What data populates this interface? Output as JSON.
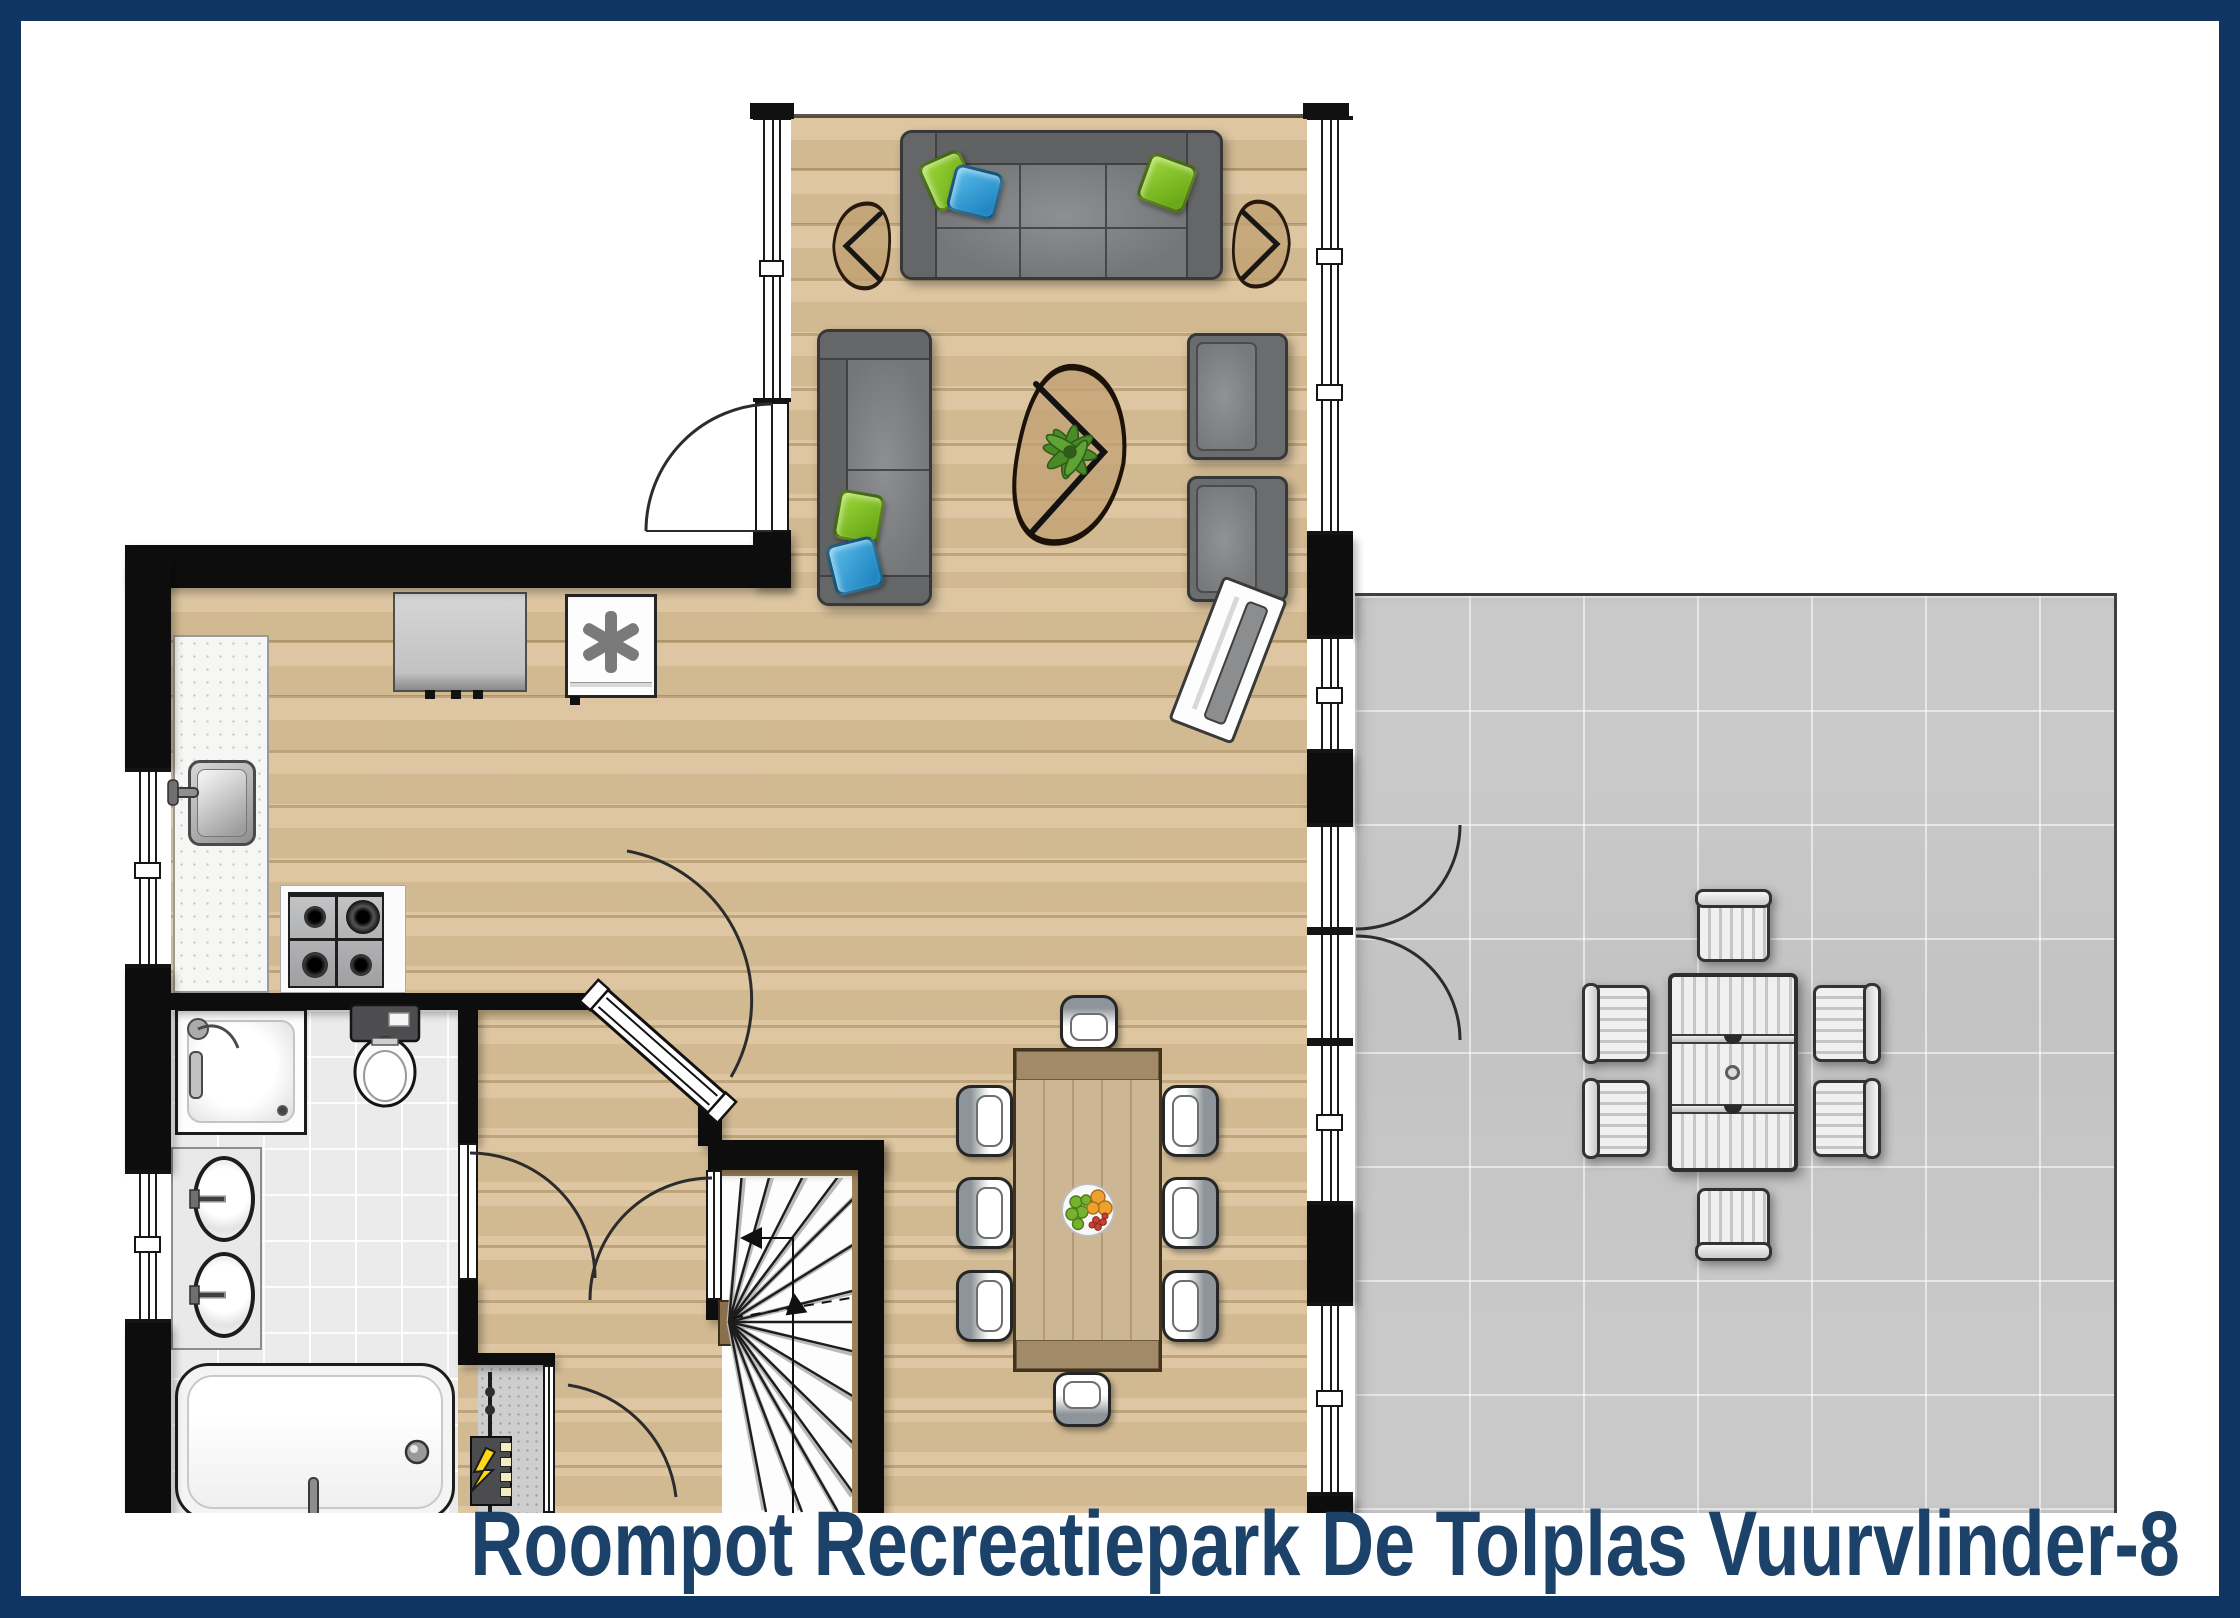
{
  "title": "Roompot Recreatiepark De Tolplas Vuurvlinder-8",
  "frame": {
    "border_color": "#113563",
    "background": "#ffffff"
  },
  "palette": {
    "wall_black": "#0d0d0d",
    "wood_floor": "#d8be94",
    "wood_plank_line": "#b79a6c",
    "terrace_tile_gray": "#c7c7c7",
    "bathroom_tile": "#ebebeb",
    "sofa_gray": "#747678",
    "pillow_green": "#7dc41e",
    "pillow_blue": "#2f9cd9",
    "side_table_wood": "#c1a274",
    "dining_table_wood": "#c9b190",
    "outdoor_furniture_white": "#f0f0f0",
    "title_navy": "#1d4269",
    "fan_symbol_gray": "#7a7a7a",
    "bolt_yellow": "#ffd913"
  },
  "icons": {
    "ventilation_fan_glyph": "✳",
    "power_bolt_glyph": "⚡"
  }
}
